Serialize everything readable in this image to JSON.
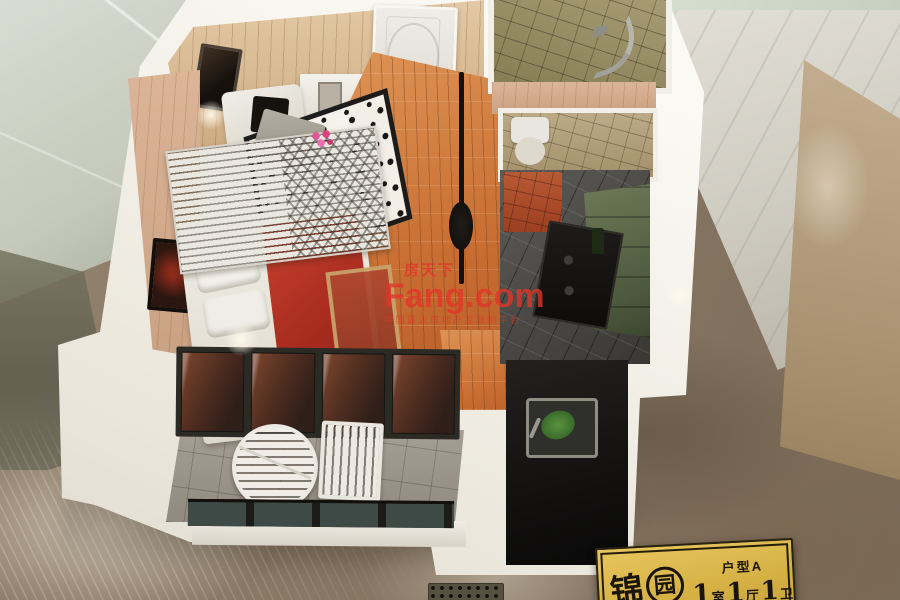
{
  "watermark": {
    "brand_cn": "房天下",
    "brand_en": "Fang.com",
    "slogan": "中国最大房地产互联网平台",
    "color": "#e23428"
  },
  "plaque": {
    "name_chars": [
      "锦",
      "园"
    ],
    "unit_label": "户型A",
    "segments": [
      {
        "num": "1",
        "unit": "室"
      },
      {
        "num": "1",
        "unit": "厅"
      },
      {
        "num": "1",
        "unit": "卫"
      }
    ],
    "colors": {
      "background": "#d6b245",
      "border": "#2a220f",
      "text": "#1b140a"
    }
  }
}
